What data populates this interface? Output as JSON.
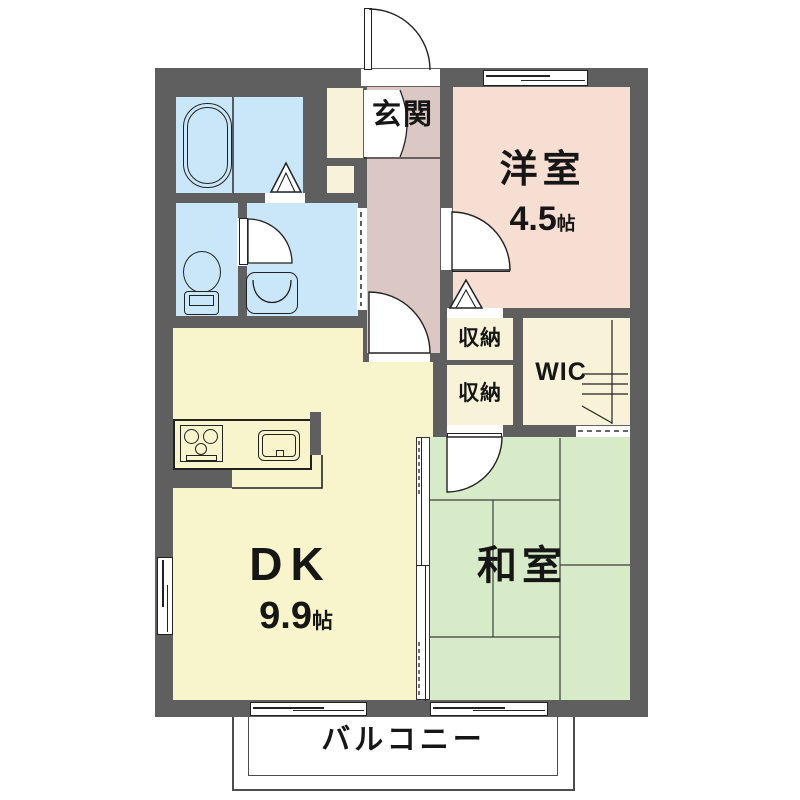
{
  "rooms": {
    "genkan": {
      "label": "玄関"
    },
    "western_room": {
      "label": "洋室",
      "size_value": "4.5",
      "size_unit": "帖"
    },
    "storage_upper": {
      "label": "収納"
    },
    "storage_lower": {
      "label": "収納"
    },
    "wic": {
      "label": "WIC"
    },
    "dk": {
      "label": "DK",
      "size_value": "9.9",
      "size_unit": "帖"
    },
    "japanese_room": {
      "label": "和室"
    },
    "balcony": {
      "label": "バルコニー"
    }
  },
  "colors": {
    "wall": "#5f5f5f",
    "wet": "#c9e7f8",
    "genkan": "#dbc7c3",
    "western": "#f7ded2",
    "storage": "#f7f2d8",
    "dk": "#f8f5cd",
    "washitsu": "#d8ebc8",
    "line": "#222222"
  },
  "icons": {
    "bathtub": "bathtub-icon",
    "toilet": "toilet-icon",
    "washbasin": "washbasin-icon",
    "stove": "gas-stove-icon",
    "sink": "kitchen-sink-icon",
    "hanger": "hanger-pipe-icon",
    "folding_door": "folding-door-icon",
    "swing_door": "swing-door-icon",
    "sliding_window": "sliding-window-icon"
  }
}
